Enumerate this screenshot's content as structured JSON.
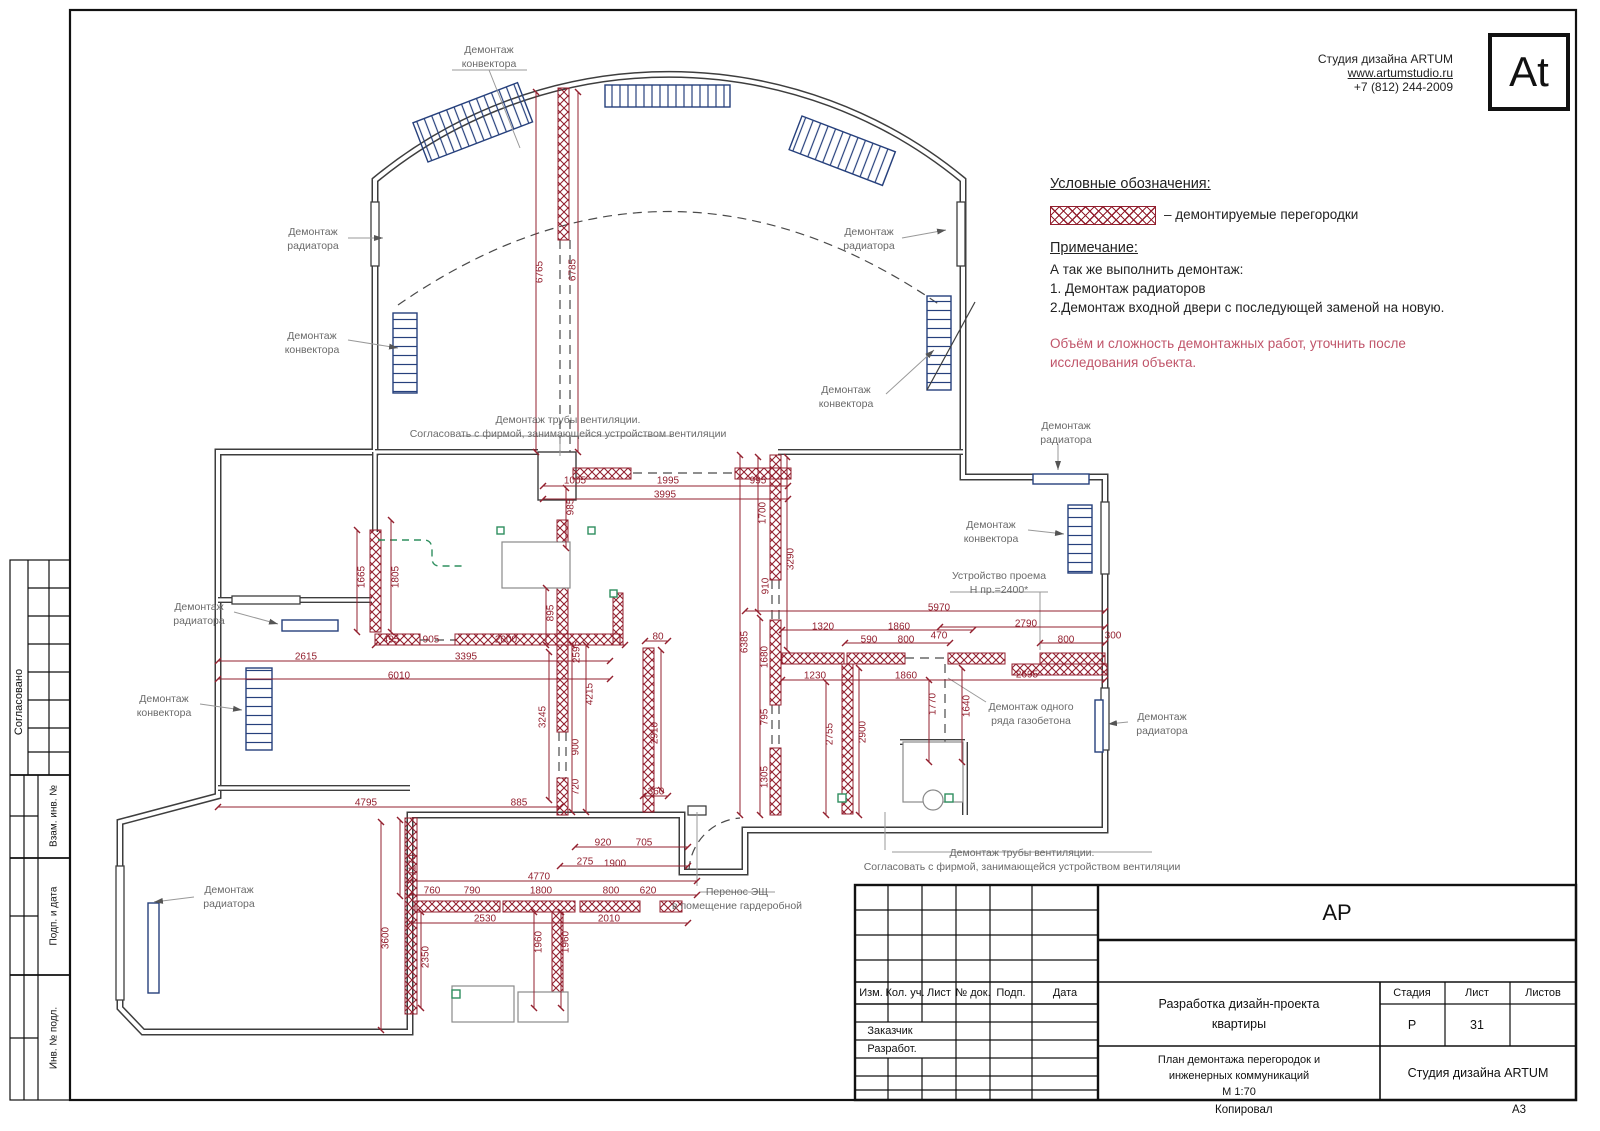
{
  "company": {
    "name": "Студия дизайна ARTUM",
    "site": "www.artumstudio.ru",
    "phone": "+7 (812) 244-2009",
    "logo": "At"
  },
  "legend": {
    "title": "Условные обозначения:",
    "item": "– демонтируемые перегородки"
  },
  "note": {
    "title": "Примечание:",
    "lines": [
      "А так же выполнить демонтаж:",
      "1. Демонтаж радиаторов",
      "2.Демонтаж входной двери с последующей заменой на новую."
    ],
    "warning": [
      "Объём и сложность демонтажных работ,  уточнить после",
      "исследования объекта."
    ]
  },
  "sidebar": {
    "sections": [
      "Согласовано",
      "Взам. инв. №",
      "Подп. и дата",
      "Инв. № подл."
    ]
  },
  "titleblock": {
    "doc_code": "АР",
    "header_cols": [
      "Изм.",
      "Кол. уч.",
      "Лист",
      "№ док.",
      "Подп.",
      "Дата"
    ],
    "left_rows": [
      "Заказчик",
      "Разработ."
    ],
    "project_lines": [
      "Разработка дизайн-проекта",
      "квартиры"
    ],
    "stage_label": "Стадия",
    "sheet_label": "Лист",
    "sheets_label": "Листов",
    "stage": "Р",
    "sheet": "31",
    "sheets": "",
    "sheet_title_lines": [
      "План демонтажа перегородок и",
      "инженерных коммуникаций"
    ],
    "scale": "М 1:70",
    "studio": "Студия дизайна ARTUM"
  },
  "footer": {
    "copied_label": "Копировал",
    "format": "А3"
  },
  "plan": {
    "callouts": [
      {
        "lines": [
          "Демонтаж",
          "конвектора"
        ],
        "x": 489,
        "y": 57
      },
      {
        "lines": [
          "Демонтаж",
          "радиатора"
        ],
        "x": 313,
        "y": 239
      },
      {
        "lines": [
          "Демонтаж",
          "конвектора"
        ],
        "x": 312,
        "y": 343
      },
      {
        "lines": [
          "Демонтаж",
          "радиатора"
        ],
        "x": 869,
        "y": 239
      },
      {
        "lines": [
          "Демонтаж",
          "конвектора"
        ],
        "x": 846,
        "y": 397
      },
      {
        "lines": [
          "Демонтаж",
          "радиатора"
        ],
        "x": 1066,
        "y": 433
      },
      {
        "lines": [
          "Демонтаж",
          "конвектора"
        ],
        "x": 991,
        "y": 532
      },
      {
        "lines": [
          "Демонтаж",
          "радиатора"
        ],
        "x": 199,
        "y": 614
      },
      {
        "lines": [
          "Демонтаж",
          "конвектора"
        ],
        "x": 164,
        "y": 706
      },
      {
        "lines": [
          "Демонтаж",
          "радиатора"
        ],
        "x": 229,
        "y": 897
      },
      {
        "lines": [
          "Демонтаж",
          "радиатора"
        ],
        "x": 1162,
        "y": 724
      },
      {
        "lines": [
          "Демонтаж одного",
          "ряда газобетона"
        ],
        "x": 1031,
        "y": 714
      },
      {
        "lines": [
          "Устройство проема",
          "Н пр.=2400*"
        ],
        "x": 999,
        "y": 583
      },
      {
        "lines": [
          "Демонтаж трубы вентиляции.",
          "Согласовать с фирмой, занимающейся устройством вентиляции"
        ],
        "x": 568,
        "y": 427
      },
      {
        "lines": [
          "Демонтаж трубы вентиляции.",
          "Согласовать с фирмой, занимающейся устройством вентиляции"
        ],
        "x": 1022,
        "y": 860
      },
      {
        "lines": [
          "Перенос ЭЩ",
          "в помещение гардеробной"
        ],
        "x": 737,
        "y": 899
      }
    ],
    "dims": [
      {
        "v": "6765",
        "x": 540,
        "y": 272,
        "o": "v"
      },
      {
        "v": "6785",
        "x": 573,
        "y": 270,
        "o": "v"
      },
      {
        "v": "1005",
        "x": 575,
        "y": 481,
        "o": "h"
      },
      {
        "v": "1995",
        "x": 668,
        "y": 481,
        "o": "h"
      },
      {
        "v": "995",
        "x": 758,
        "y": 481,
        "o": "h"
      },
      {
        "v": "3995",
        "x": 665,
        "y": 495,
        "o": "h"
      },
      {
        "v": "985",
        "x": 571,
        "y": 507,
        "o": "v"
      },
      {
        "v": "1700",
        "x": 763,
        "y": 513,
        "o": "v"
      },
      {
        "v": "3290",
        "x": 791,
        "y": 559,
        "o": "v"
      },
      {
        "v": "910",
        "x": 766,
        "y": 586,
        "o": "v"
      },
      {
        "v": "1665",
        "x": 362,
        "y": 577,
        "o": "v"
      },
      {
        "v": "1805",
        "x": 396,
        "y": 577,
        "o": "v"
      },
      {
        "v": "895",
        "x": 551,
        "y": 613,
        "o": "v"
      },
      {
        "v": "495",
        "x": 391,
        "y": 640,
        "o": "h"
      },
      {
        "v": "905",
        "x": 431,
        "y": 640,
        "o": "h"
      },
      {
        "v": "2000",
        "x": 506,
        "y": 640,
        "o": "h"
      },
      {
        "v": "3395",
        "x": 466,
        "y": 657,
        "o": "h"
      },
      {
        "v": "2615",
        "x": 306,
        "y": 657,
        "o": "h"
      },
      {
        "v": "6010",
        "x": 399,
        "y": 676,
        "o": "h"
      },
      {
        "v": "2595",
        "x": 577,
        "y": 652,
        "o": "v"
      },
      {
        "v": "4215",
        "x": 590,
        "y": 694,
        "o": "v"
      },
      {
        "v": "3245",
        "x": 543,
        "y": 717,
        "o": "v"
      },
      {
        "v": "900",
        "x": 576,
        "y": 747,
        "o": "v"
      },
      {
        "v": "720",
        "x": 576,
        "y": 787,
        "o": "v"
      },
      {
        "v": "80",
        "x": 658,
        "y": 637,
        "o": "h"
      },
      {
        "v": "2910",
        "x": 655,
        "y": 733,
        "o": "v"
      },
      {
        "v": "360",
        "x": 656,
        "y": 792,
        "o": "h"
      },
      {
        "v": "885",
        "x": 519,
        "y": 803,
        "o": "h"
      },
      {
        "v": "4795",
        "x": 366,
        "y": 803,
        "o": "h"
      },
      {
        "v": "920",
        "x": 603,
        "y": 843,
        "o": "h"
      },
      {
        "v": "705",
        "x": 644,
        "y": 843,
        "o": "h"
      },
      {
        "v": "275",
        "x": 585,
        "y": 862,
        "o": "h"
      },
      {
        "v": "1900",
        "x": 615,
        "y": 864,
        "o": "h"
      },
      {
        "v": "4770",
        "x": 539,
        "y": 877,
        "o": "h"
      },
      {
        "v": "1170",
        "x": 413,
        "y": 865,
        "o": "v"
      },
      {
        "v": "760",
        "x": 432,
        "y": 891,
        "o": "h"
      },
      {
        "v": "790",
        "x": 472,
        "y": 891,
        "o": "h"
      },
      {
        "v": "1800",
        "x": 541,
        "y": 891,
        "o": "h"
      },
      {
        "v": "800",
        "x": 611,
        "y": 891,
        "o": "h"
      },
      {
        "v": "620",
        "x": 648,
        "y": 891,
        "o": "h"
      },
      {
        "v": "2530",
        "x": 485,
        "y": 919,
        "o": "h"
      },
      {
        "v": "2010",
        "x": 609,
        "y": 919,
        "o": "h"
      },
      {
        "v": "3600",
        "x": 386,
        "y": 938,
        "o": "v"
      },
      {
        "v": "2350",
        "x": 426,
        "y": 957,
        "o": "v"
      },
      {
        "v": "1960",
        "x": 539,
        "y": 942,
        "o": "v"
      },
      {
        "v": "1960",
        "x": 566,
        "y": 942,
        "o": "v"
      },
      {
        "v": "6385",
        "x": 745,
        "y": 642,
        "o": "v"
      },
      {
        "v": "1680",
        "x": 765,
        "y": 657,
        "o": "v"
      },
      {
        "v": "795",
        "x": 765,
        "y": 717,
        "o": "v"
      },
      {
        "v": "1305",
        "x": 765,
        "y": 777,
        "o": "v"
      },
      {
        "v": "5970",
        "x": 939,
        "y": 608,
        "o": "h"
      },
      {
        "v": "1320",
        "x": 823,
        "y": 627,
        "o": "h"
      },
      {
        "v": "1860",
        "x": 899,
        "y": 627,
        "o": "h"
      },
      {
        "v": "2790",
        "x": 1026,
        "y": 624,
        "o": "h"
      },
      {
        "v": "590",
        "x": 869,
        "y": 640,
        "o": "h"
      },
      {
        "v": "800",
        "x": 906,
        "y": 640,
        "o": "h"
      },
      {
        "v": "470",
        "x": 939,
        "y": 636,
        "o": "h"
      },
      {
        "v": "800",
        "x": 1066,
        "y": 640,
        "o": "h"
      },
      {
        "v": "300",
        "x": 1113,
        "y": 636,
        "o": "h"
      },
      {
        "v": "1230",
        "x": 815,
        "y": 676,
        "o": "h"
      },
      {
        "v": "1860",
        "x": 906,
        "y": 676,
        "o": "h"
      },
      {
        "v": "2695",
        "x": 1027,
        "y": 675,
        "o": "h"
      },
      {
        "v": "2755",
        "x": 830,
        "y": 734,
        "o": "v"
      },
      {
        "v": "2900",
        "x": 863,
        "y": 732,
        "o": "v"
      },
      {
        "v": "1770",
        "x": 933,
        "y": 704,
        "o": "v"
      },
      {
        "v": "1640",
        "x": 967,
        "y": 706,
        "o": "v"
      }
    ]
  }
}
